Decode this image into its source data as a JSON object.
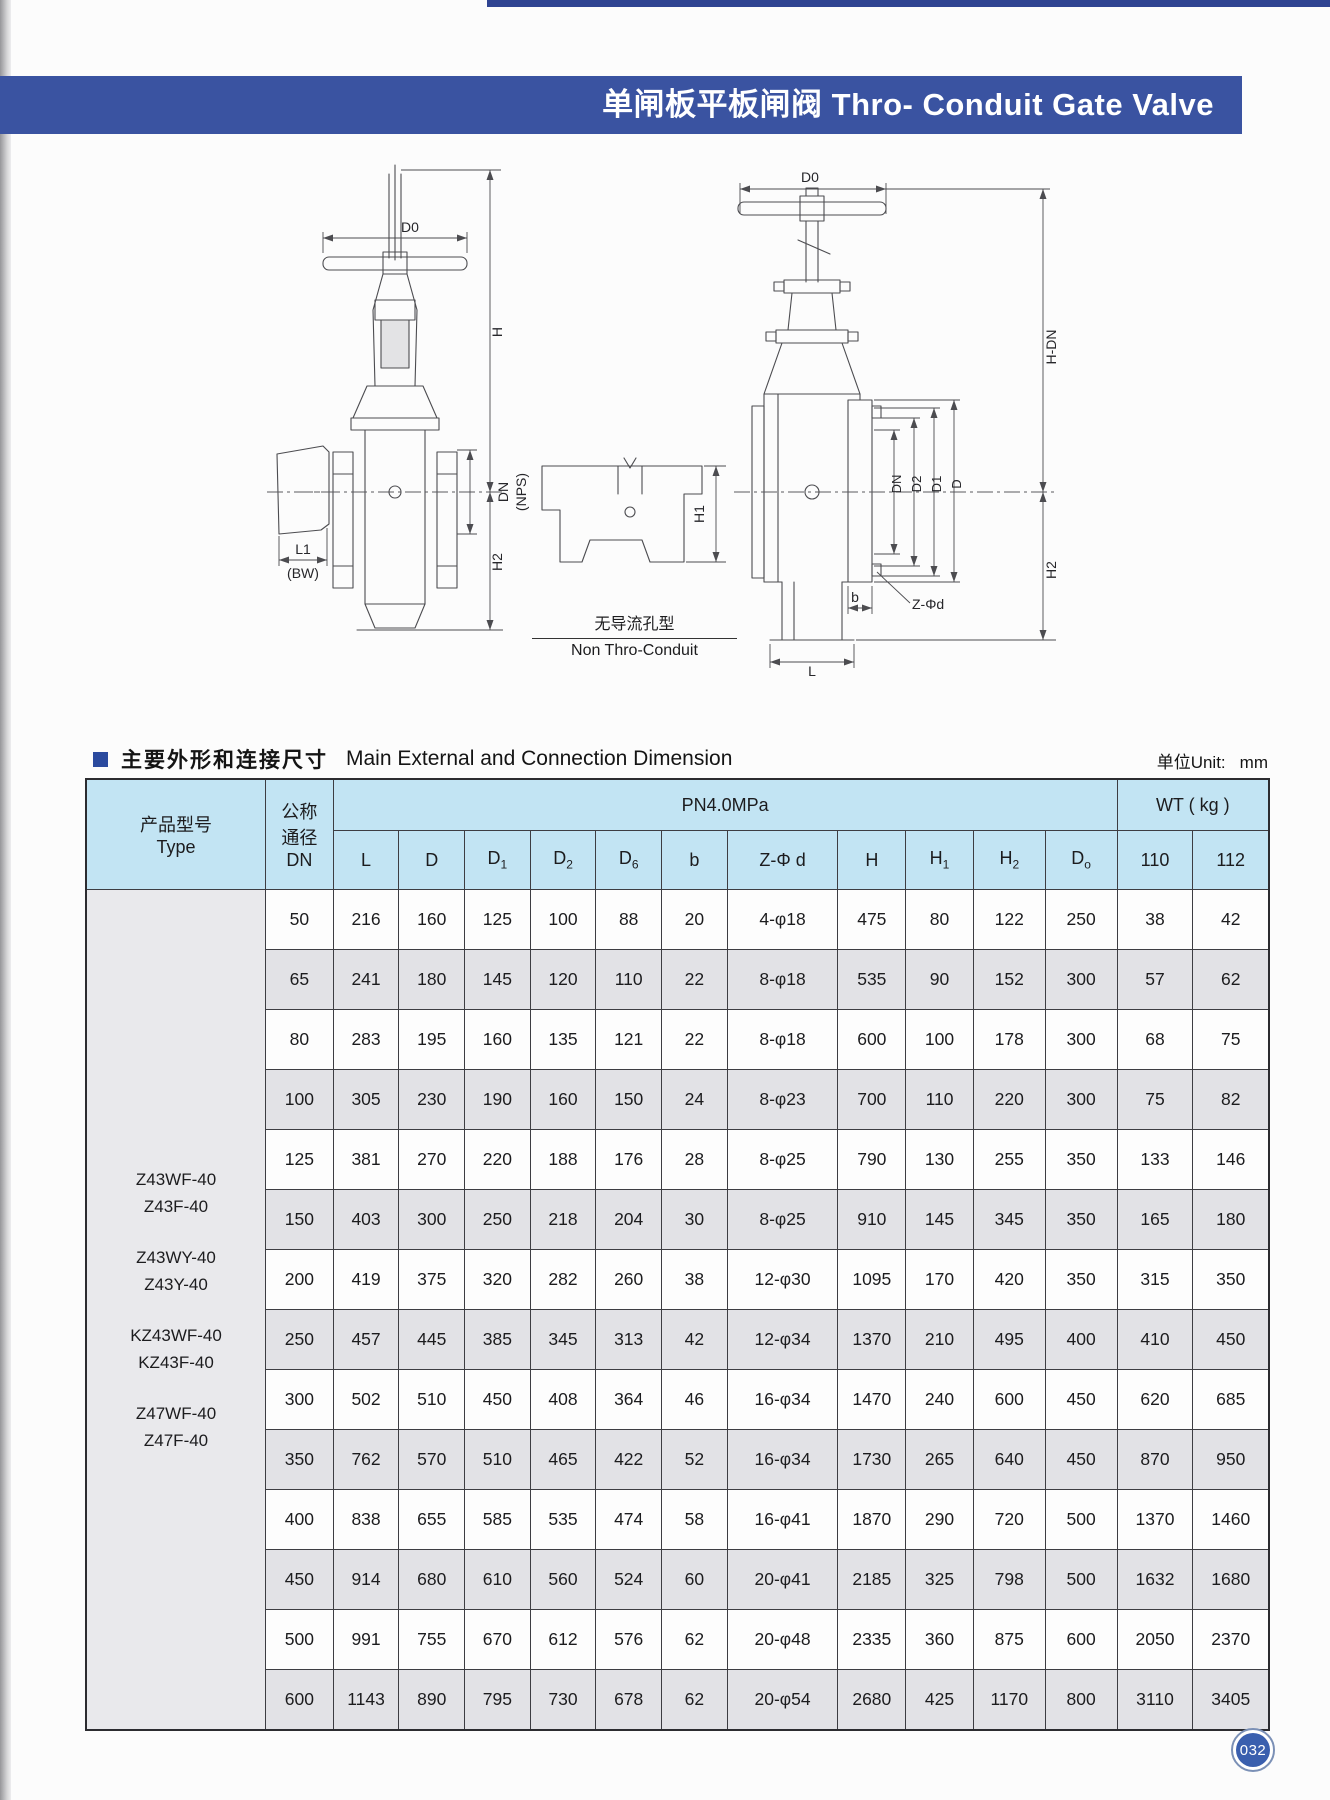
{
  "page": {
    "banner_title": "单闸板平板闸阀 Thro- Conduit Gate Valve",
    "page_number": "032"
  },
  "section": {
    "title_zh": "主要外形和连接尺寸",
    "title_en": "Main External and Connection Dimension",
    "unit_label": "单位Unit:",
    "unit_value": "mm"
  },
  "drawings": {
    "left": {
      "dim_d0": "D0",
      "dim_h": "H",
      "dim_dn": "DN",
      "dim_nps": "(NPS)",
      "dim_h2": "H2",
      "dim_l1": "L1",
      "dim_bw": "(BW)"
    },
    "middle": {
      "dim_h1": "H1",
      "caption_zh": "无导流孔型",
      "caption_en": "Non Thro-Conduit"
    },
    "right": {
      "dim_d0": "D0",
      "dim_hdn": "H-DN",
      "dim_dn": "DN",
      "dim_d2": "D2",
      "dim_d1": "D1",
      "dim_d": "D",
      "dim_b": "b",
      "dim_zphid": "Z-Φd",
      "dim_h2": "H2",
      "dim_l": "L"
    }
  },
  "table": {
    "header": {
      "type_zh": "产品型号",
      "type_en": "Type",
      "dn_zh1": "公称",
      "dn_zh2": "通径",
      "dn_en": "DN",
      "group_pn": "PN4.0MPa",
      "group_wt": "WT ( kg )",
      "columns": [
        {
          "b": "L"
        },
        {
          "b": "D"
        },
        {
          "b": "D",
          "s": "1"
        },
        {
          "b": "D",
          "s": "2"
        },
        {
          "b": "D",
          "s": "6"
        },
        {
          "b": "b"
        },
        {
          "b": "Z-Φ d"
        },
        {
          "b": "H"
        },
        {
          "b": "H",
          "s": "1"
        },
        {
          "b": "H",
          "s": "2"
        },
        {
          "b": "D",
          "s": "o"
        },
        {
          "b": "110"
        },
        {
          "b": "112"
        }
      ]
    },
    "types": [
      "Z43WF-40",
      "Z43F-40",
      "Z43WY-40",
      "Z43Y-40",
      "KZ43WF-40",
      "KZ43F-40",
      "Z47WF-40",
      "Z47F-40"
    ],
    "rows": [
      {
        "dn": "50",
        "v": [
          "216",
          "160",
          "125",
          "100",
          "88",
          "20",
          "4-φ18",
          "475",
          "80",
          "122",
          "250",
          "38",
          "42"
        ]
      },
      {
        "dn": "65",
        "v": [
          "241",
          "180",
          "145",
          "120",
          "110",
          "22",
          "8-φ18",
          "535",
          "90",
          "152",
          "300",
          "57",
          "62"
        ]
      },
      {
        "dn": "80",
        "v": [
          "283",
          "195",
          "160",
          "135",
          "121",
          "22",
          "8-φ18",
          "600",
          "100",
          "178",
          "300",
          "68",
          "75"
        ]
      },
      {
        "dn": "100",
        "v": [
          "305",
          "230",
          "190",
          "160",
          "150",
          "24",
          "8-φ23",
          "700",
          "110",
          "220",
          "300",
          "75",
          "82"
        ]
      },
      {
        "dn": "125",
        "v": [
          "381",
          "270",
          "220",
          "188",
          "176",
          "28",
          "8-φ25",
          "790",
          "130",
          "255",
          "350",
          "133",
          "146"
        ]
      },
      {
        "dn": "150",
        "v": [
          "403",
          "300",
          "250",
          "218",
          "204",
          "30",
          "8-φ25",
          "910",
          "145",
          "345",
          "350",
          "165",
          "180"
        ]
      },
      {
        "dn": "200",
        "v": [
          "419",
          "375",
          "320",
          "282",
          "260",
          "38",
          "12-φ30",
          "1095",
          "170",
          "420",
          "350",
          "315",
          "350"
        ]
      },
      {
        "dn": "250",
        "v": [
          "457",
          "445",
          "385",
          "345",
          "313",
          "42",
          "12-φ34",
          "1370",
          "210",
          "495",
          "400",
          "410",
          "450"
        ]
      },
      {
        "dn": "300",
        "v": [
          "502",
          "510",
          "450",
          "408",
          "364",
          "46",
          "16-φ34",
          "1470",
          "240",
          "600",
          "450",
          "620",
          "685"
        ]
      },
      {
        "dn": "350",
        "v": [
          "762",
          "570",
          "510",
          "465",
          "422",
          "52",
          "16-φ34",
          "1730",
          "265",
          "640",
          "450",
          "870",
          "950"
        ]
      },
      {
        "dn": "400",
        "v": [
          "838",
          "655",
          "585",
          "535",
          "474",
          "58",
          "16-φ41",
          "1870",
          "290",
          "720",
          "500",
          "1370",
          "1460"
        ]
      },
      {
        "dn": "450",
        "v": [
          "914",
          "680",
          "610",
          "560",
          "524",
          "60",
          "20-φ41",
          "2185",
          "325",
          "798",
          "500",
          "1632",
          "1680"
        ]
      },
      {
        "dn": "500",
        "v": [
          "991",
          "755",
          "670",
          "612",
          "576",
          "62",
          "20-φ48",
          "2335",
          "360",
          "875",
          "600",
          "2050",
          "2370"
        ]
      },
      {
        "dn": "600",
        "v": [
          "1143",
          "890",
          "795",
          "730",
          "678",
          "62",
          "20-φ54",
          "2680",
          "425",
          "1170",
          "800",
          "3110",
          "3405"
        ]
      }
    ]
  }
}
